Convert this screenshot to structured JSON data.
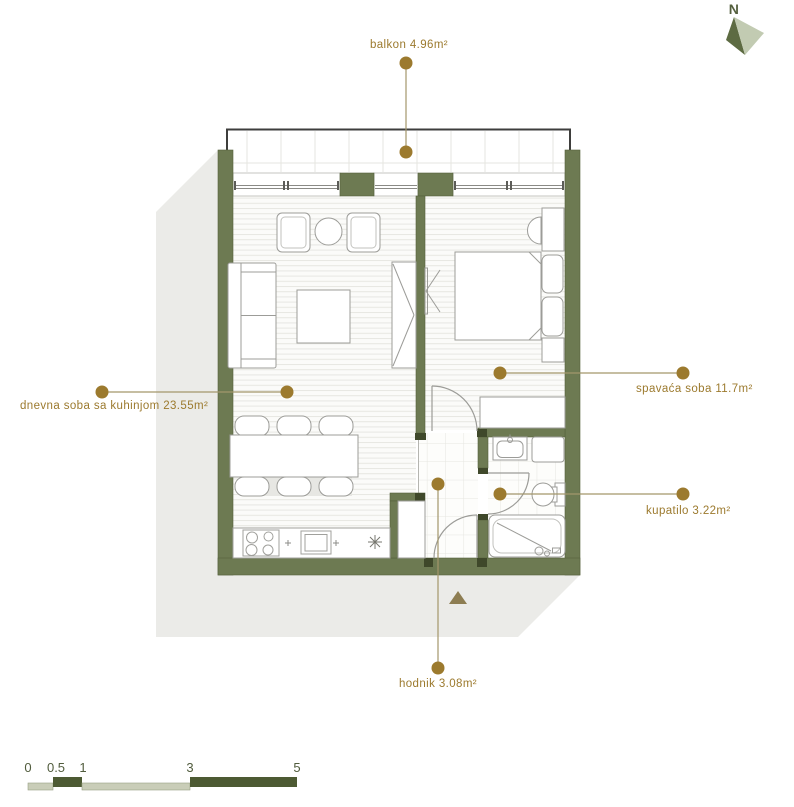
{
  "north": {
    "label": "N"
  },
  "labels": {
    "balkon": "balkon 4.96m²",
    "dnevna": "dnevna soba sa kuhinjom 23.55m²",
    "spavaca": "spavaća soba 11.7m²",
    "kupatilo": "kupatilo 3.22m²",
    "hodnik": "hodnik 3.08m²"
  },
  "rooms": [
    {
      "name": "balkon",
      "area_m2": 4.96
    },
    {
      "name": "dnevna soba sa kuhinjom",
      "area_m2": 23.55
    },
    {
      "name": "spavaća soba",
      "area_m2": 11.7
    },
    {
      "name": "kupatilo",
      "area_m2": 3.22
    },
    {
      "name": "hodnik",
      "area_m2": 3.08
    }
  ],
  "scale_bar": {
    "ticks": [
      "0",
      "0.5",
      "1",
      "3",
      "5"
    ],
    "unit": "m"
  },
  "colors": {
    "wall": "#6d7a52",
    "wall_dark_jamb": "#3f482a",
    "dimension_gold": "#9c7a2e",
    "leader_line": "#a3966b",
    "shadow": "#ebebe8",
    "scale_light": "#c9cdb8",
    "scale_dark": "#4d5a33",
    "north_light": "#c2cbb2",
    "north_dark": "#5d6b42",
    "furniture_outline": "#9c9c98"
  }
}
